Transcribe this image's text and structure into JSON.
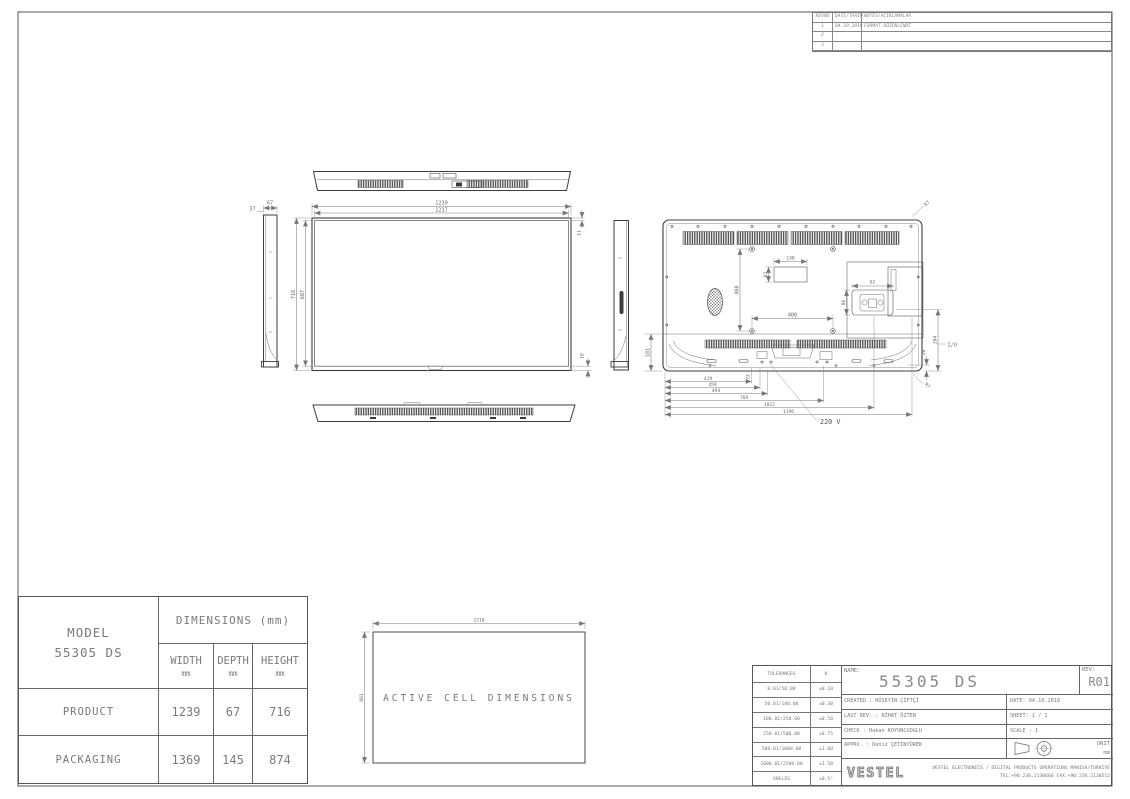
{
  "colors": {
    "line": "#3d3d3d",
    "dim": "#777777",
    "text": "#6b6b6b"
  },
  "revision_table": {
    "headers": {
      "no": "REVNO",
      "date": "DATE/TARİH",
      "notes": "NOTES/AÇIKLAMALAR"
    },
    "rows": [
      {
        "no": "1",
        "date": "04.10.2018",
        "note": "FORMAT DÜZENLENDİ"
      },
      {
        "no": "2",
        "date": "",
        "note": ""
      },
      {
        "no": "3",
        "date": "",
        "note": ""
      }
    ]
  },
  "drawing": {
    "front": {
      "width_outer": "1239",
      "width_inner": "1217",
      "height_outer": "716",
      "height_inner": "687",
      "bezel_top": "11",
      "bezel_bottom": "18"
    },
    "side": {
      "depth_total": "67",
      "depth_front": "37"
    },
    "back": {
      "vesa_horizontal": "400",
      "vesa_vertical": "400",
      "recess_width": "130",
      "recess_height": "62",
      "inlet_width": "62",
      "inlet_height": "80",
      "bottom_section_height": "181",
      "io_vertical_offset": "294",
      "io_edge_offset": "29",
      "corner_radius_top": "R7",
      "corner_radius_bottom": "R7",
      "stand_offset": "33",
      "chain": [
        "419",
        "459",
        "494",
        "769",
        "1012",
        "1196"
      ],
      "power_label": "220 V",
      "io_label": "I/O"
    },
    "active_cell": {
      "width": "1210",
      "height": "681",
      "label": "ACTIVE CELL DIMENSIONS"
    }
  },
  "dimensions_table": {
    "model_label": "MODEL",
    "model_value": "55305 DS",
    "header": "DIMENSIONS (mm)",
    "columns": [
      {
        "label": "WIDTH",
        "unit": "mm"
      },
      {
        "label": "DEPTH",
        "unit": "mm"
      },
      {
        "label": "HEIGHT",
        "unit": "mm"
      }
    ],
    "rows": [
      {
        "label": "PRODUCT",
        "width": "1239",
        "depth": "67",
        "height": "716"
      },
      {
        "label": "PACKAGING",
        "width": "1369",
        "depth": "145",
        "height": "874"
      }
    ]
  },
  "title_block": {
    "tolerances": {
      "header": "TOLERANCES",
      "k": "K",
      "rows": [
        {
          "range": "0.01/50.00",
          "value": "±0.10"
        },
        {
          "range": "50.01/100.00",
          "value": "±0.30"
        },
        {
          "range": "100.01/250.00",
          "value": "±0.50"
        },
        {
          "range": "250.01/500.00",
          "value": "±0.75"
        },
        {
          "range": "500.01/1000.00",
          "value": "±1.00"
        },
        {
          "range": "1000.01/2500.00",
          "value": "±1.50"
        },
        {
          "range": "ANGLES",
          "value": "±0,5°"
        }
      ]
    },
    "name_label": "NAME:",
    "name_value": "55305 DS",
    "rev_label": "REV:",
    "rev_value": "R01",
    "created": "CREATED : HÜSEYİN ÇİFTÇİ",
    "last_rev": "LAST REV. : NİHAT ÖZTEN",
    "check": "CHECK : Hakan KOYUNCUOGLU",
    "approved": "APPRV. : Deniz ÇETİNYÜREK",
    "date": "DATE: 04.10.2018",
    "sheet": "SHEET: 1 / 1",
    "scale": "SCALE : 1",
    "unit_label": "UNIT",
    "unit_value": "mm",
    "company": "VESTEL",
    "footer_line1": "VESTEL ELECTRONICS / DIGITAL PRODUCTS OPERATIONS MANISA/TURKIYE",
    "footer_line2": "TEL:+90.236.2130660 FAX:+90.236.2130512"
  }
}
